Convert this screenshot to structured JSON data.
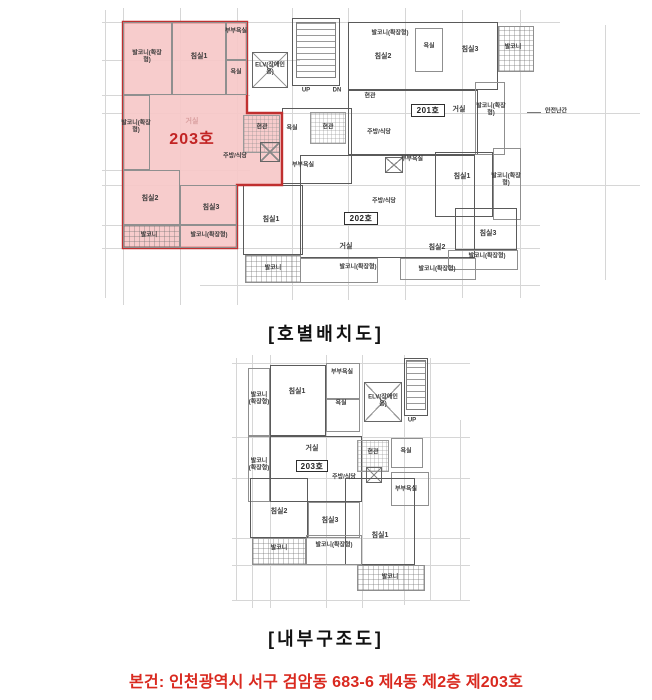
{
  "captions": {
    "plan1": "[호별배치도]",
    "plan2": "[내부구조도]"
  },
  "footer": {
    "text": "본건: 인천광역시 서구 검암동 683-6 제4동 제2층 제203호"
  },
  "colors": {
    "highlight_fill": "#f6c8c8",
    "highlight_stroke": "#c03030",
    "footer_red": "#d9291f",
    "grid": "#d6d6d6"
  },
  "plans": [
    {
      "name": "unit-layout-plan",
      "grid": {
        "v": [
          {
            "x": 105,
            "y1": 10,
            "y2": 298
          },
          {
            "x": 123,
            "y1": 8,
            "y2": 305
          },
          {
            "x": 180,
            "y1": 8,
            "y2": 305
          },
          {
            "x": 237,
            "y1": 8,
            "y2": 305
          },
          {
            "x": 292,
            "y1": 8,
            "y2": 300
          },
          {
            "x": 348,
            "y1": 8,
            "y2": 300
          },
          {
            "x": 405,
            "y1": 8,
            "y2": 300
          },
          {
            "x": 462,
            "y1": 10,
            "y2": 298
          },
          {
            "x": 520,
            "y1": 10,
            "y2": 298
          },
          {
            "x": 605,
            "y1": 25,
            "y2": 280
          }
        ],
        "h": [
          {
            "y": 22,
            "x1": 102,
            "x2": 560
          },
          {
            "y": 60,
            "x1": 102,
            "x2": 300
          },
          {
            "y": 95,
            "x1": 102,
            "x2": 250
          },
          {
            "y": 113,
            "x1": 102,
            "x2": 640
          },
          {
            "y": 170,
            "x1": 102,
            "x2": 250
          },
          {
            "y": 185,
            "x1": 102,
            "x2": 640
          },
          {
            "y": 225,
            "x1": 102,
            "x2": 540
          },
          {
            "y": 248,
            "x1": 102,
            "x2": 540
          },
          {
            "y": 285,
            "x1": 200,
            "x2": 540
          }
        ]
      },
      "boxes": [
        {
          "t": "wall",
          "x": 292,
          "y": 18,
          "w": 48,
          "h": 68
        },
        {
          "t": "stairs",
          "x": 296,
          "y": 22,
          "w": 40,
          "h": 56
        },
        {
          "t": "elv",
          "x": 252,
          "y": 52,
          "w": 36,
          "h": 36
        },
        {
          "t": "wall",
          "x": 348,
          "y": 22,
          "w": 150,
          "h": 68
        },
        {
          "t": "balcony",
          "x": 498,
          "y": 26,
          "w": 36,
          "h": 46
        },
        {
          "t": "room",
          "x": 415,
          "y": 28,
          "w": 28,
          "h": 44
        },
        {
          "t": "wall",
          "x": 348,
          "y": 90,
          "w": 130,
          "h": 65
        },
        {
          "t": "room",
          "x": 475,
          "y": 82,
          "w": 30,
          "h": 73
        },
        {
          "t": "wall",
          "x": 282,
          "y": 108,
          "w": 70,
          "h": 76
        },
        {
          "t": "hatch",
          "x": 310,
          "y": 112,
          "w": 36,
          "h": 32
        },
        {
          "t": "wall",
          "x": 300,
          "y": 155,
          "w": 175,
          "h": 103
        },
        {
          "t": "room",
          "x": 300,
          "y": 258,
          "w": 78,
          "h": 25
        },
        {
          "t": "room",
          "x": 400,
          "y": 258,
          "w": 76,
          "h": 22
        },
        {
          "t": "wall",
          "x": 243,
          "y": 185,
          "w": 60,
          "h": 70
        },
        {
          "t": "balcony",
          "x": 245,
          "y": 255,
          "w": 56,
          "h": 28
        },
        {
          "t": "wall",
          "x": 435,
          "y": 152,
          "w": 58,
          "h": 65
        },
        {
          "t": "room",
          "x": 493,
          "y": 148,
          "w": 28,
          "h": 72
        },
        {
          "t": "wall",
          "x": 455,
          "y": 208,
          "w": 62,
          "h": 42
        },
        {
          "t": "room",
          "x": 448,
          "y": 250,
          "w": 70,
          "h": 20
        },
        {
          "t": "shaft",
          "x": 385,
          "y": 157,
          "w": 18,
          "h": 16
        },
        {
          "t": "hline",
          "x": 527,
          "y": 112,
          "w": 14,
          "h": 1
        }
      ],
      "highlight": {
        "points": "123,22 247,22 247,113 282,113 282,185 237,185 237,248 123,248"
      },
      "overlay_boxes": [
        {
          "t": "room",
          "x": 123,
          "y": 22,
          "w": 49,
          "h": 73
        },
        {
          "t": "room",
          "x": 172,
          "y": 22,
          "w": 54,
          "h": 73
        },
        {
          "t": "room",
          "x": 226,
          "y": 22,
          "w": 21,
          "h": 38
        },
        {
          "t": "room",
          "x": 226,
          "y": 60,
          "w": 21,
          "h": 35
        },
        {
          "t": "room",
          "x": 123,
          "y": 95,
          "w": 27,
          "h": 75
        },
        {
          "t": "hatch",
          "x": 243,
          "y": 115,
          "w": 37,
          "h": 38
        },
        {
          "t": "shaft",
          "x": 260,
          "y": 142,
          "w": 20,
          "h": 20
        },
        {
          "t": "room",
          "x": 123,
          "y": 170,
          "w": 57,
          "h": 55
        },
        {
          "t": "room",
          "x": 180,
          "y": 185,
          "w": 57,
          "h": 40
        },
        {
          "t": "balcony",
          "x": 123,
          "y": 225,
          "w": 57,
          "h": 23
        },
        {
          "t": "room",
          "x": 180,
          "y": 225,
          "w": 57,
          "h": 23
        },
        {
          "t": "badge",
          "x": 344,
          "y": 212,
          "w": 34,
          "h": 13,
          "text": "202호"
        },
        {
          "t": "badge",
          "x": 411,
          "y": 104,
          "w": 34,
          "h": 13,
          "text": "201호"
        }
      ],
      "labels": [
        {
          "text": "발코니(확장형)",
          "x": 147,
          "y": 57,
          "s": 6,
          "w": 34
        },
        {
          "text": "침실1",
          "x": 199,
          "y": 57,
          "s": 7
        },
        {
          "text": "부부욕실",
          "x": 236,
          "y": 32,
          "s": 6
        },
        {
          "text": "욕실",
          "x": 236,
          "y": 73,
          "s": 6
        },
        {
          "text": "발코니(확장형)",
          "x": 136,
          "y": 127,
          "s": 6,
          "w": 30
        },
        {
          "text": "거실",
          "x": 192,
          "y": 122,
          "s": 7,
          "cls": "faint"
        },
        {
          "text": "203호",
          "x": 192,
          "y": 140,
          "s": 16,
          "cls": "unit-red"
        },
        {
          "text": "현관",
          "x": 262,
          "y": 128,
          "s": 6
        },
        {
          "text": "주방/식당",
          "x": 235,
          "y": 157,
          "s": 6
        },
        {
          "text": "침실2",
          "x": 150,
          "y": 199,
          "s": 7
        },
        {
          "text": "침실3",
          "x": 211,
          "y": 208,
          "s": 7
        },
        {
          "text": "발코니",
          "x": 149,
          "y": 236,
          "s": 6
        },
        {
          "text": "발코니(확장형)",
          "x": 209,
          "y": 236,
          "s": 6
        },
        {
          "text": "ELV(장애인용)",
          "x": 270,
          "y": 69,
          "s": 6,
          "w": 32
        },
        {
          "text": "UP",
          "x": 306,
          "y": 91,
          "s": 6
        },
        {
          "text": "DN",
          "x": 337,
          "y": 91,
          "s": 6
        },
        {
          "text": "욕실",
          "x": 292,
          "y": 129,
          "s": 6
        },
        {
          "text": "현관",
          "x": 328,
          "y": 128,
          "s": 6
        },
        {
          "text": "부부욕실",
          "x": 303,
          "y": 166,
          "s": 6
        },
        {
          "text": "주방/식당",
          "x": 384,
          "y": 202,
          "s": 6
        },
        {
          "text": "거실",
          "x": 346,
          "y": 247,
          "s": 7
        },
        {
          "text": "침실2",
          "x": 437,
          "y": 248,
          "s": 7
        },
        {
          "text": "발코니(확장형)",
          "x": 358,
          "y": 268,
          "s": 6
        },
        {
          "text": "발코니(확장형)",
          "x": 437,
          "y": 270,
          "s": 6
        },
        {
          "text": "침실1",
          "x": 271,
          "y": 220,
          "s": 7
        },
        {
          "text": "발코니",
          "x": 273,
          "y": 269,
          "s": 6
        },
        {
          "text": "발코니(확장형)",
          "x": 390,
          "y": 34,
          "s": 6
        },
        {
          "text": "침실2",
          "x": 383,
          "y": 57,
          "s": 7
        },
        {
          "text": "욕실",
          "x": 429,
          "y": 47,
          "s": 6
        },
        {
          "text": "침실3",
          "x": 470,
          "y": 50,
          "s": 7
        },
        {
          "text": "발코니",
          "x": 513,
          "y": 48,
          "s": 6
        },
        {
          "text": "현관",
          "x": 370,
          "y": 97,
          "s": 6
        },
        {
          "text": "거실",
          "x": 459,
          "y": 110,
          "s": 7
        },
        {
          "text": "발코니(확장형)",
          "x": 491,
          "y": 110,
          "s": 6,
          "w": 30
        },
        {
          "text": "안전난간",
          "x": 556,
          "y": 112,
          "s": 6
        },
        {
          "text": "주방/식당",
          "x": 379,
          "y": 133,
          "s": 6
        },
        {
          "text": "부부욕실",
          "x": 412,
          "y": 160,
          "s": 6
        },
        {
          "text": "침실1",
          "x": 462,
          "y": 177,
          "s": 7
        },
        {
          "text": "발코니(확장형)",
          "x": 506,
          "y": 180,
          "s": 6,
          "w": 30
        },
        {
          "text": "침실3",
          "x": 488,
          "y": 234,
          "s": 7
        },
        {
          "text": "발코니(확장형)",
          "x": 487,
          "y": 257,
          "s": 6
        }
      ]
    },
    {
      "name": "internal-structure-plan",
      "grid": {
        "v": [
          {
            "x": 236,
            "y1": 358,
            "y2": 600
          },
          {
            "x": 252,
            "y1": 355,
            "y2": 608
          },
          {
            "x": 270,
            "y1": 355,
            "y2": 608
          },
          {
            "x": 326,
            "y1": 355,
            "y2": 608
          },
          {
            "x": 362,
            "y1": 355,
            "y2": 608
          },
          {
            "x": 404,
            "y1": 355,
            "y2": 605
          },
          {
            "x": 430,
            "y1": 358,
            "y2": 600
          },
          {
            "x": 460,
            "y1": 420,
            "y2": 600
          }
        ],
        "h": [
          {
            "y": 363,
            "x1": 232,
            "x2": 470
          },
          {
            "y": 437,
            "x1": 232,
            "x2": 470
          },
          {
            "y": 478,
            "x1": 232,
            "x2": 470
          },
          {
            "y": 538,
            "x1": 232,
            "x2": 470
          },
          {
            "y": 565,
            "x1": 232,
            "x2": 470
          },
          {
            "y": 600,
            "x1": 232,
            "x2": 470
          }
        ]
      },
      "boxes": [
        {
          "t": "room",
          "x": 248,
          "y": 368,
          "w": 22,
          "h": 68
        },
        {
          "t": "wall",
          "x": 270,
          "y": 365,
          "w": 56,
          "h": 71
        },
        {
          "t": "room",
          "x": 326,
          "y": 363,
          "w": 34,
          "h": 36
        },
        {
          "t": "room",
          "x": 326,
          "y": 399,
          "w": 34,
          "h": 33
        },
        {
          "t": "elv",
          "x": 364,
          "y": 382,
          "w": 38,
          "h": 40
        },
        {
          "t": "wall",
          "x": 404,
          "y": 358,
          "w": 24,
          "h": 58
        },
        {
          "t": "stairs",
          "x": 406,
          "y": 360,
          "w": 20,
          "h": 50
        },
        {
          "t": "room",
          "x": 248,
          "y": 436,
          "w": 22,
          "h": 66
        },
        {
          "t": "wall",
          "x": 270,
          "y": 436,
          "w": 92,
          "h": 66
        },
        {
          "t": "hatch",
          "x": 357,
          "y": 440,
          "w": 32,
          "h": 32
        },
        {
          "t": "room",
          "x": 391,
          "y": 438,
          "w": 32,
          "h": 30
        },
        {
          "t": "room",
          "x": 391,
          "y": 472,
          "w": 38,
          "h": 34
        },
        {
          "t": "shaft",
          "x": 366,
          "y": 467,
          "w": 16,
          "h": 16
        },
        {
          "t": "wall",
          "x": 250,
          "y": 478,
          "w": 58,
          "h": 60
        },
        {
          "t": "room",
          "x": 308,
          "y": 502,
          "w": 52,
          "h": 36
        },
        {
          "t": "wall",
          "x": 345,
          "y": 478,
          "w": 70,
          "h": 87
        },
        {
          "t": "balcony",
          "x": 252,
          "y": 538,
          "w": 54,
          "h": 27
        },
        {
          "t": "room",
          "x": 306,
          "y": 535,
          "w": 56,
          "h": 30
        },
        {
          "t": "balcony",
          "x": 357,
          "y": 565,
          "w": 68,
          "h": 26
        },
        {
          "t": "badge",
          "x": 296,
          "y": 460,
          "w": 32,
          "h": 12,
          "text": "203호"
        }
      ],
      "overlay_boxes": [],
      "labels": [
        {
          "text": "발코니(확장형)",
          "x": 259,
          "y": 399,
          "s": 6,
          "w": 24
        },
        {
          "text": "침실1",
          "x": 297,
          "y": 392,
          "s": 7
        },
        {
          "text": "부부욕실",
          "x": 342,
          "y": 373,
          "s": 6
        },
        {
          "text": "욕실",
          "x": 341,
          "y": 404,
          "s": 6
        },
        {
          "text": "ELV(장애인용)",
          "x": 383,
          "y": 401,
          "s": 6,
          "w": 32
        },
        {
          "text": "UP",
          "x": 412,
          "y": 421,
          "s": 6
        },
        {
          "text": "발코니(확장형)",
          "x": 259,
          "y": 465,
          "s": 6,
          "w": 24
        },
        {
          "text": "거실",
          "x": 312,
          "y": 449,
          "s": 7
        },
        {
          "text": "현관",
          "x": 373,
          "y": 453,
          "s": 6
        },
        {
          "text": "욕실",
          "x": 406,
          "y": 452,
          "s": 6
        },
        {
          "text": "부부욕실",
          "x": 406,
          "y": 490,
          "s": 6
        },
        {
          "text": "주방/식당",
          "x": 344,
          "y": 478,
          "s": 6
        },
        {
          "text": "침실2",
          "x": 279,
          "y": 512,
          "s": 7
        },
        {
          "text": "침실3",
          "x": 330,
          "y": 521,
          "s": 7
        },
        {
          "text": "침실1",
          "x": 380,
          "y": 536,
          "s": 7
        },
        {
          "text": "발코니",
          "x": 279,
          "y": 549,
          "s": 6
        },
        {
          "text": "발코니(확장형)",
          "x": 334,
          "y": 546,
          "s": 6
        },
        {
          "text": "발코니",
          "x": 390,
          "y": 578,
          "s": 6
        }
      ]
    }
  ]
}
